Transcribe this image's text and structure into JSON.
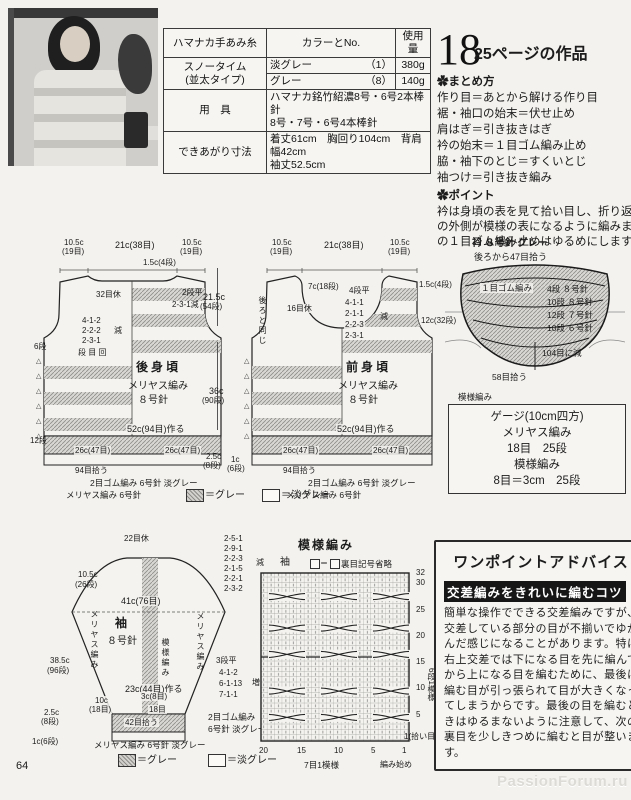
{
  "page": {
    "number": "64",
    "watermark": "PassionForum.ru"
  },
  "marker": {
    "triangle_column": "△\n△\n△\n△\n△\n△"
  },
  "info_table": {
    "headers": {
      "yarn": "ハマナカ手あみ糸",
      "color": "カラーとNo.",
      "amount": "使用量"
    },
    "yarn_name": "スノータイム",
    "yarn_type": "(並太タイプ)",
    "rows": [
      {
        "color": "淡グレー",
        "no": "（1）",
        "amount": "380g"
      },
      {
        "color": "グレー",
        "no": "（8）",
        "amount": "140g"
      }
    ],
    "tools_label": "用　具",
    "tools1": "ハマナカ銘竹紹濃8号・6号2本棒針",
    "tools2": "8号・7号・6号4本棒針",
    "size_label": "できあがり寸法",
    "size1": "着丈61cm　胸回り104cm　背肩幅42cm",
    "size2": "袖丈52.5cm"
  },
  "work": {
    "number": "18",
    "title": "25ページの作品"
  },
  "summary": {
    "heading": "✿まとめ方",
    "items": [
      "作り目＝あとから解ける作り目",
      "裾・袖口の始末＝伏せ止め",
      "肩はぎ＝引き抜きはぎ",
      "衿の始末＝１目ゴム編み止め",
      "脇・袖下のとじ＝すくいとじ",
      "袖つけ＝引き抜き編み"
    ],
    "point_heading": "✿ポイント",
    "point_lines": [
      "衿は身頃の表を見て拾い目し、折り返した",
      "の外側が模様の表になるように編みます。",
      "の１目ゴム編み止めはゆるめにします。"
    ]
  },
  "back": {
    "name": "後身頃",
    "stitch": "メリヤス編み",
    "needle": "８号針",
    "w1": "10.5c",
    "w1b": "(19目)",
    "w2": "21c(38目)",
    "w3": "10.5c",
    "w3b": "(19目)",
    "shoulder": "1.5c(4段)",
    "rest": "32目休",
    "flat": "2段平",
    "neck_dec": "2-3-1減",
    "decs": [
      "4-1-2",
      "2-2-2",
      "2-3-1"
    ],
    "dec_label": "減",
    "dec_cols": "段 目 回",
    "r6": "6段",
    "r12": "12段",
    "cast": "52c(94目)作る",
    "half1": "26c(47目)",
    "half2": "26c(47目)",
    "pickup": "94目拾う",
    "rib": "2目ゴム編み 6号針 淡グレー",
    "hem": "メリヤス編み 6号針"
  },
  "front": {
    "name": "前身頃",
    "stitch": "メリヤス編み",
    "needle": "８号針",
    "w1": "10.5c",
    "w1b": "(19目)",
    "w2": "21c(38目)",
    "w3": "10.5c",
    "w3b": "(19目)",
    "depth": "7c(18段)",
    "rest": "16目休",
    "same": "後ろと同じ",
    "flat": "4段平",
    "decs": [
      "4-1-1",
      "2-1-1",
      "2-2-3",
      "2-3-1"
    ],
    "dec_label": "減",
    "cast": "52c(94目)作る",
    "half1": "26c(47目)",
    "half2": "26c(47目)",
    "pickup": "94目拾う",
    "rib": "2目ゴム編み 6号針 淡グレー",
    "hem": "メリヤス編み 6号針"
  },
  "dims": {
    "armhole": "21.5c",
    "armhole_b": "(54段)",
    "body": "36c",
    "body_b": "(90段)",
    "rib": "2.5c",
    "rib_b": "(8段)",
    "hem": "1c",
    "hem_b": "(6段)"
  },
  "collar": {
    "title": "衿 ８号針 グレー",
    "pickup_back": "後ろから47目拾う",
    "top": "1.5c(4段)",
    "side": "12c(32段)",
    "rib": "１目ゴム編み",
    "steps": [
      "4段 ８号針",
      "10段 ８号針",
      "12段 ７号針",
      "10段 ６号針"
    ],
    "dec": "104目に減",
    "pickup": "58目拾う",
    "pattern": "模様編み"
  },
  "gauge": {
    "title": "ゲージ(10cm四方)",
    "l1": "メリヤス編み",
    "l2": "18目　25段",
    "l3": "模様編み",
    "l4": "8目＝3cm　25段"
  },
  "legend": {
    "gray": "＝グレー",
    "light": "＝淡グレー"
  },
  "sleeve": {
    "rest": "22目休",
    "caps": [
      "2-5-1",
      "2-9-1",
      "2-2-3",
      "2-1-5",
      "2-2-1",
      "2-3-2"
    ],
    "cap_label": "減",
    "cap_h": "10.5c",
    "cap_h_b": "(26段)",
    "width": "41c(76目)",
    "name": "袖",
    "needle": "８号針",
    "left": "メリヤス編み",
    "center": "模様編み",
    "right": "メリヤス編み",
    "len": "38.5c",
    "len_b": "(96段)",
    "flat": "3段平",
    "incs": [
      "4-1-2",
      "6-1-13",
      "7-1-1"
    ],
    "inc_label": "増",
    "cast": "23c(44目)作る",
    "w1": "10c",
    "w1b": "(18目)",
    "w2": "3c(8目)",
    "w3": "18目",
    "rib_h": "2.5c",
    "rib_h_b": "(8段)",
    "hem_h": "1c(6段)",
    "pickup": "42目拾う",
    "rib1": "2目ゴム編み",
    "rib2": "6号針 淡グレー",
    "hem": "メリヤス編み 6号針 淡グレー"
  },
  "chart": {
    "title": "模様編み",
    "part": "袖",
    "eq": "＝",
    "legend": "裏目記号省略",
    "rows": [
      "32",
      "30",
      "25",
      "20",
      "15",
      "10",
      "5"
    ],
    "row1": "1(拾い目)",
    "cols": [
      "20",
      "15",
      "10",
      "5",
      "1"
    ],
    "xrep": "7目1模様",
    "yrep": "6段1模様",
    "start": "編み始め"
  },
  "advice": {
    "title": "ワンポイントアドバイス",
    "subtitle": "交差編みをきれいに編むコツ",
    "body": "簡単な操作でできる交差編みですが、交差している部分の目が不揃いでゆがんだ感じになることがあります。特に右上交差では下になる目を先に編んでから上になる目を編むために、最後に編む目が引っ張られて目が大きくなってしまうからです。最後の目を編むときはゆるまないように注意して、次の裏目を少しきつめに編むと目が整います。"
  }
}
